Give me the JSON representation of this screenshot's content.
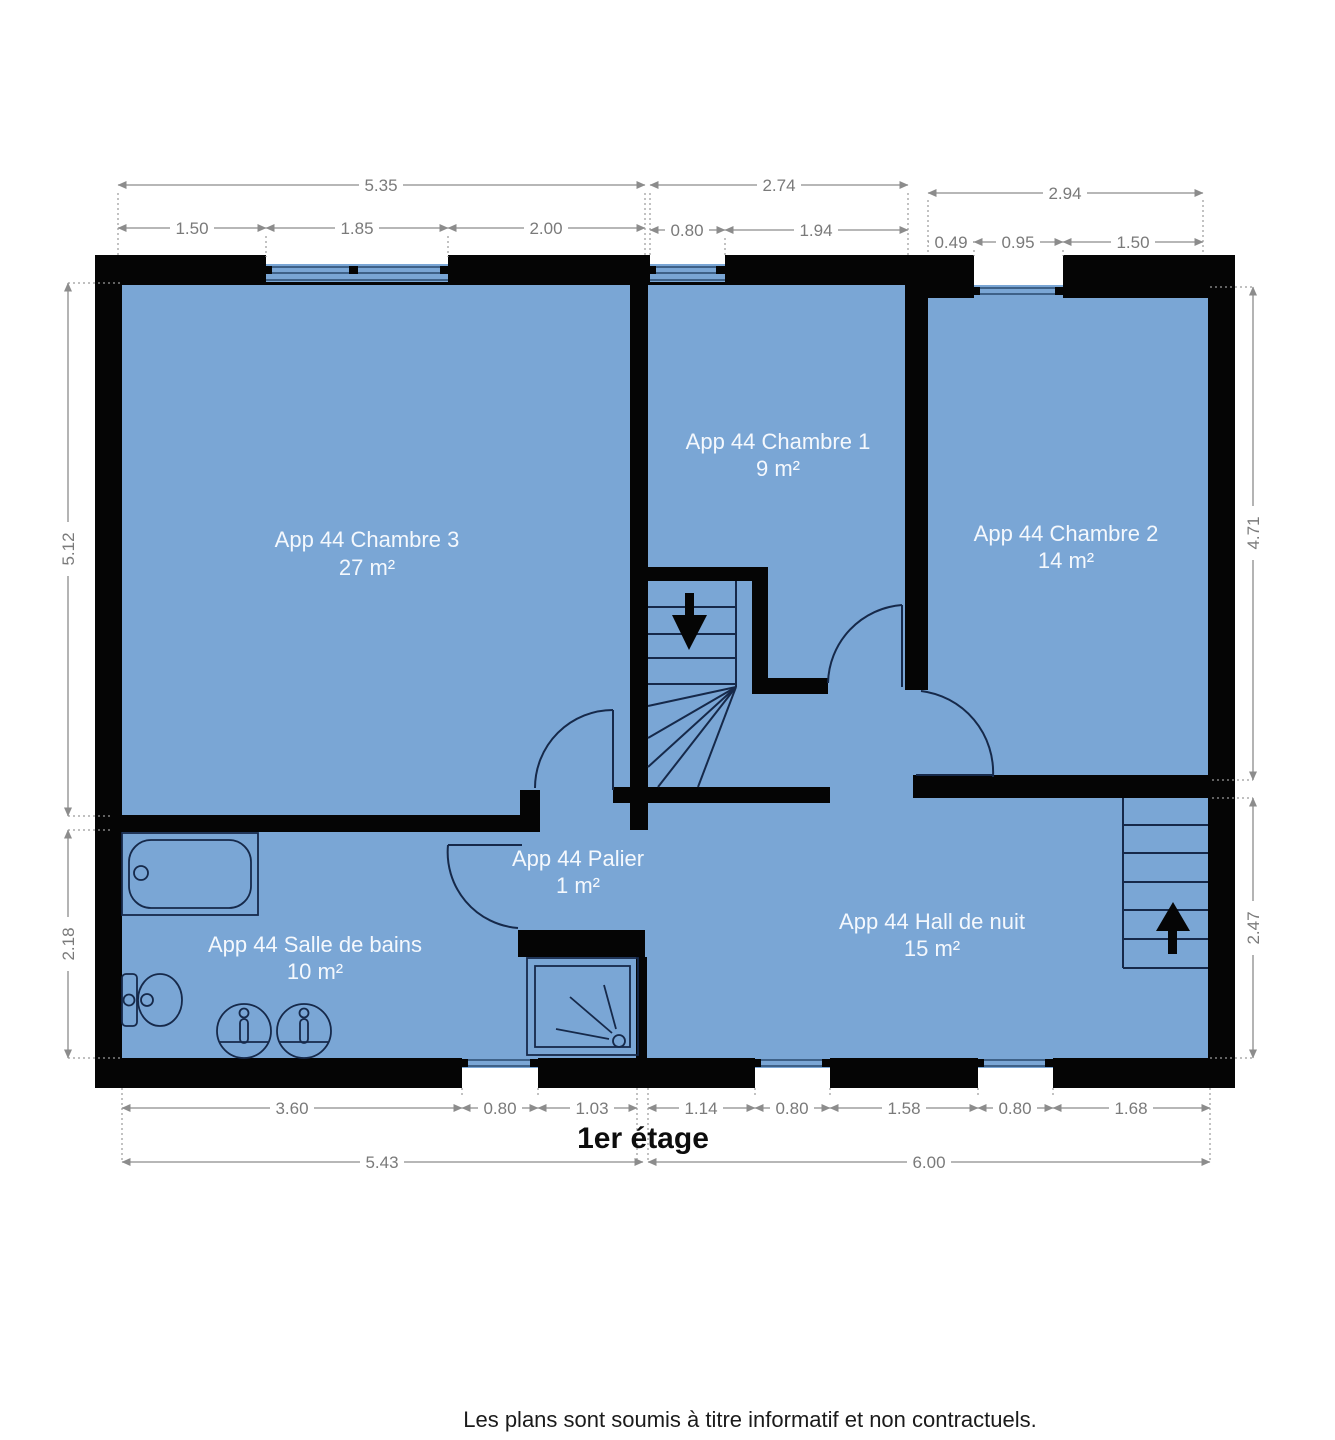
{
  "title": "1er étage",
  "disclaimer": "Les plans sont soumis à titre informatif et non contractuels.",
  "rooms": [
    {
      "name": "App 44 Chambre 3",
      "area": "27 m²"
    },
    {
      "name": "App 44 Chambre 1",
      "area": "9 m²"
    },
    {
      "name": "App 44 Chambre 2",
      "area": "14 m²"
    },
    {
      "name": "App 44 Palier",
      "area": "1 m²"
    },
    {
      "name": "App 44 Salle de bains",
      "area": "10 m²"
    },
    {
      "name": "App 44 Hall de nuit",
      "area": "15 m²"
    }
  ],
  "dimensions": {
    "top_overall": [
      "5.35",
      "2.74",
      "2.94"
    ],
    "top_segments": [
      "1.50",
      "1.85",
      "2.00",
      "0.80",
      "1.94",
      "0.49",
      "0.95",
      "1.50"
    ],
    "left": [
      "5.12",
      "2.18"
    ],
    "right": [
      "4.71",
      "2.47"
    ],
    "bottom_segments": [
      "3.60",
      "0.80",
      "1.03",
      "1.14",
      "0.80",
      "1.58",
      "0.80",
      "1.68"
    ],
    "bottom_overall": [
      "5.43",
      "6.00"
    ]
  },
  "colors": {
    "floor": "#7aa6d5",
    "wall": "#050505",
    "fixture": "#16294a",
    "dimension": "#7d7d7d"
  }
}
